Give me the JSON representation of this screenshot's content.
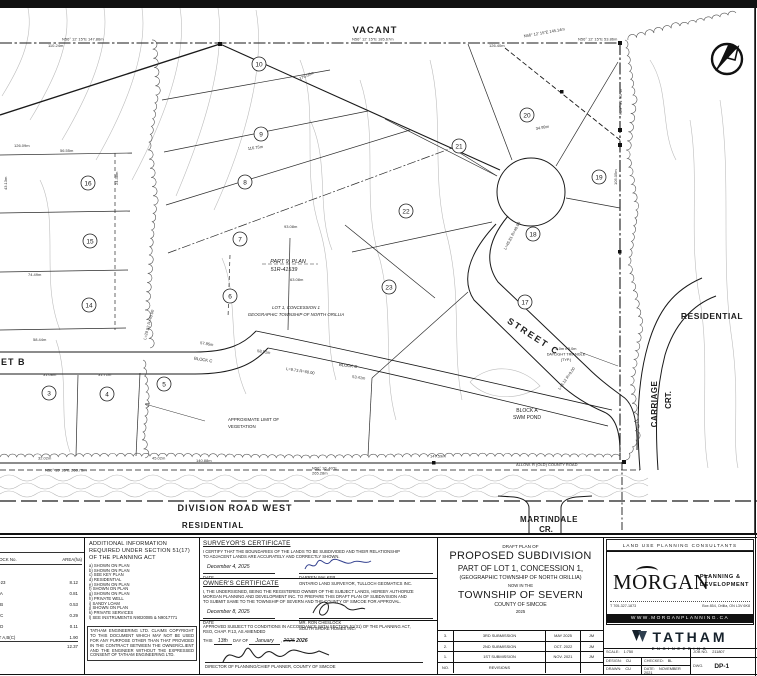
{
  "map": {
    "labels": {
      "vacant": "VACANT",
      "street_b": "STREET B",
      "street_c": "STREET C",
      "division_road": "DIVISION ROAD WEST",
      "residential_south": "RESIDENTIAL",
      "residential_east": "RESIDENTIAL",
      "martindale": "MARTINDALE",
      "martindale_cr": "CR.",
      "carriage": "CARRIAGE",
      "carriage_crt": "CRT.",
      "block_a_1": "BLOCK A",
      "block_a_2": "SWM POND",
      "block_c_1": "BLOCK C",
      "block_c_2": "BLOCK C",
      "part9_1": "PART 9, PLAN",
      "part9_2": "51R-41539",
      "lot1_1": "LOT 1, CONCESSION 1",
      "lot1_2": "GEOGRAPHIC TOWNSHIP OF NORTH ORILLIA",
      "veg_1": "APPROXIMATE LIMIT OF",
      "veg_2": "VEGETATION",
      "daylight_1": "5.0m x 5.0m",
      "daylight_2": "DAYLIGHT TRIANGLE",
      "daylight_3": "(TYP.)"
    },
    "lot_circles": [
      {
        "n": "3",
        "x": 49,
        "y": 393
      },
      {
        "n": "4",
        "x": 107,
        "y": 394
      },
      {
        "n": "5",
        "x": 164,
        "y": 384
      },
      {
        "n": "6",
        "x": 230,
        "y": 296
      },
      {
        "n": "7",
        "x": 240,
        "y": 239
      },
      {
        "n": "8",
        "x": 245,
        "y": 182
      },
      {
        "n": "9",
        "x": 261,
        "y": 134
      },
      {
        "n": "10",
        "x": 259,
        "y": 64
      },
      {
        "n": "14",
        "x": 89,
        "y": 305
      },
      {
        "n": "15",
        "x": 90,
        "y": 241
      },
      {
        "n": "16",
        "x": 88,
        "y": 183
      },
      {
        "n": "17",
        "x": 525,
        "y": 302
      },
      {
        "n": "18",
        "x": 533,
        "y": 234
      },
      {
        "n": "19",
        "x": 599,
        "y": 177
      },
      {
        "n": "20",
        "x": 527,
        "y": 115
      },
      {
        "n": "21",
        "x": 459,
        "y": 146
      },
      {
        "n": "22",
        "x": 406,
        "y": 211
      },
      {
        "n": "23",
        "x": 389,
        "y": 287
      }
    ],
    "dimension_labels": [
      {
        "t": "N56° 12' 15\"E  147.86m",
        "x": 62,
        "y": 40.5,
        "r": 0
      },
      {
        "t": "110.24m",
        "x": 48,
        "y": 47,
        "r": 0
      },
      {
        "t": "N56° 12' 15\"E  185.67m",
        "x": 352,
        "y": 40.5,
        "r": 0
      },
      {
        "t": "126.40m",
        "x": 489,
        "y": 47,
        "r": 0
      },
      {
        "t": "N56° 12' 15\"E 145.14m",
        "x": 524,
        "y": 37.5,
        "r": -10
      },
      {
        "t": "N56° 12' 15\"E  53.86m",
        "x": 578,
        "y": 40.5,
        "r": 0
      },
      {
        "t": "176.09m",
        "x": 300,
        "y": 80,
        "r": -24
      },
      {
        "t": "116.75m",
        "x": 248,
        "y": 150,
        "r": -8
      },
      {
        "t": "93.08m",
        "x": 284,
        "y": 228,
        "r": 0
      },
      {
        "t": "63.08m",
        "x": 290,
        "y": 281,
        "r": 0
      },
      {
        "t": "57.85m",
        "x": 200,
        "y": 344,
        "r": 9
      },
      {
        "t": "58.91m",
        "x": 257,
        "y": 352,
        "r": 9
      },
      {
        "t": "53.41m",
        "x": 352,
        "y": 378,
        "r": 7
      },
      {
        "t": "N29° 31' 30\"W",
        "x": 622,
        "y": 115,
        "r": -90
      },
      {
        "t": "105.05m",
        "x": 617,
        "y": 185,
        "r": -90
      },
      {
        "t": "N56° 15' 15\"E  268.75m",
        "x": 45,
        "y": 471.5,
        "r": 0
      },
      {
        "t": "140.88m",
        "x": 196,
        "y": 462,
        "r": 0
      },
      {
        "t": "45.02m",
        "x": 152,
        "y": 459.5,
        "r": 0
      },
      {
        "t": "32.02m",
        "x": 38,
        "y": 459.5,
        "r": 0
      },
      {
        "t": "31.08m",
        "x": 43,
        "y": 376,
        "r": 0
      },
      {
        "t": "31.71m",
        "x": 98,
        "y": 376,
        "r": 0
      },
      {
        "t": "24.38m",
        "x": 118,
        "y": 185,
        "r": -90
      },
      {
        "t": "74.49m",
        "x": 28,
        "y": 276,
        "r": 0
      },
      {
        "t": "58.44m",
        "x": 33,
        "y": 341,
        "r": 0
      },
      {
        "t": "56.55m",
        "x": 60,
        "y": 152,
        "r": 0
      },
      {
        "t": "126.09m",
        "x": 14,
        "y": 147,
        "r": 0
      },
      {
        "t": "43.13m",
        "x": 7,
        "y": 190,
        "r": -90
      },
      {
        "t": "147.59m",
        "x": 430,
        "y": 457.5,
        "r": 0
      },
      {
        "t": "N56° 16' 40\"E",
        "x": 312,
        "y": 469.5,
        "r": 0
      },
      {
        "t": "265.28m",
        "x": 312,
        "y": 474.5,
        "r": 0
      },
      {
        "t": "34.99m",
        "x": 536,
        "y": 130,
        "r": -10
      },
      {
        "t": "L=29.52 R=40.00",
        "x": 146,
        "y": 340,
        "r": -75
      },
      {
        "t": "L=9.73 R=60.00",
        "x": 286,
        "y": 370,
        "r": 9
      },
      {
        "t": "L=45.81 R=40.00",
        "x": 506,
        "y": 250,
        "r": -62
      },
      {
        "t": "L=8.12 R=9.00",
        "x": 560,
        "y": 390,
        "r": -55
      },
      {
        "t": "ALLOW. R (OLD) COUNTY ROAD",
        "x": 516,
        "y": 466,
        "r": 0
      }
    ]
  },
  "titleblock": {
    "area_table": {
      "head_col1": "LOT/BLOCK No.",
      "head_col2": "AREA(ha)",
      "rows": [
        {
          "label": "LOTS 1-23",
          "value": "8.12"
        },
        {
          "label": "BLOCK A",
          "value": "0.81"
        },
        {
          "label": "BLOCK B",
          "value": "0.53"
        },
        {
          "label": "BLOCK C",
          "value": "0.29"
        },
        {
          "label": "BLOCK D",
          "value": "0.11"
        },
        {
          "label": "STREET A,B(C)",
          "value": "1.90"
        }
      ],
      "total": "12.37"
    },
    "additional_info": {
      "title": "ADDITIONAL INFORMATION REQUIRED UNDER SECTION 51(17) OF THE PLANNING ACT",
      "items": [
        "a) SHOWN ON PLAN",
        "b) SHOWN ON PLAN",
        "c) SEE KEY PLAN",
        "d) RESIDENTIAL",
        "e) SHOWN ON PLAN",
        "f) SHOWN ON PLAN",
        "g) SHOWN ON PLAN",
        "h) PRIVATE WELL",
        "i) SANDY LOAM",
        "j) SHOWN ON PLAN",
        "k) PRIVATE SERVICES",
        "l) SEE INSTRUMENTS N9020085 & N9017771"
      ]
    },
    "copyright": "TATHAM ENGINEERING LTD. CLAIMS COPYRIGHT TO THIS DOCUMENT WHICH MAY NOT BE USED FOR ANY PURPOSE OTHER THAN THAT PROVIDED IN THE CONTRACT BETWEEN THE OWNER/CLIENT AND THE ENGINEER WITHOUT THE EXPRESSED CONSENT OF TATHAM ENGINEERING LTD.",
    "surveyor": {
      "title": "SURVEYOR'S CERTIFICATE",
      "body1": "I CERTIFY THAT THE BOUNDARIES OF THE LANDS TO BE SUBDIVIDED AND THEIR RELATIONSHIP",
      "body2": "TO ADJACENT LANDS ARE ACCURATELY AND CORRECTLY SHOWN.",
      "date": "December 4, 2025",
      "date_label": "DATE",
      "name": "DARREN WALKER",
      "name2": "ONTARIO LAND SURVEYOR, TULLOCH GEOMATICS INC."
    },
    "owner": {
      "title": "OWNER'S CERTIFICATE",
      "body1": "I, THE UNDERSIGNED, BEING THE REGISTERED OWNER OF THE SUBJECT LANDS, HEREBY AUTHORIZE",
      "body2": "MORGAN PLANNING AND DEVELOPMENT INC. TO PREPARE THIS DRAFT PLAN OF SUBDIVISION AND",
      "body3": "TO SUBMIT SAME TO THE TOWNSHIP OF SEVERN AND THE COUNTY OF SIMCOE FOR APPROVAL.",
      "date": "December 8, 2025",
      "date_label": "DATE",
      "name": "MR. RON CHESLOCK",
      "name2": "SOUTH SHORE HOMES INC."
    },
    "approval": {
      "line1": "APPROVED SUBJECT TO CONDITIONS IN ACCORDANCE WITH SECTION 51(31) OF THE PLANNING ACT,",
      "line2": "RSO, CHAP. P.13, AS AMENDED",
      "this_label": "THIS",
      "day": "13th",
      "dayof_label": "DAY OF",
      "month": "January",
      "comma": ",",
      "year_old": "2025",
      "year_new": "2026",
      "sig_title": "DIRECTOR OF PLANNING/CHIEF PLANNER, COUNTY OF SIMCOE"
    },
    "title": {
      "l1": "DRAFT PLAN OF",
      "l2": "PROPOSED SUBDIVISION",
      "l3": "PART OF LOT 1, CONCESSION 1,",
      "l4": "(GEOGRAPHIC TOWNSHIP OF NORTH ORILLIA)",
      "l5": "NOW IN THE",
      "l6": "TOWNSHIP OF SEVERN",
      "l7": "COUNTY OF SIMCOE",
      "l8": "2025"
    },
    "revisions": {
      "rows": [
        [
          "3.",
          "3RD SUBMISSION",
          "MAY 2025",
          "JM"
        ],
        [
          "2.",
          "2ND SUBMISSION",
          "OCT. 2022",
          "JM"
        ],
        [
          "1.",
          "1ST SUBMISSION",
          "NOV. 2021",
          "JM"
        ],
        [
          "NO.",
          "REVISIONS",
          "",
          ""
        ]
      ]
    },
    "consultant": {
      "band": "LAND USE PLANNING CONSULTANTS",
      "name": "MORGAN",
      "tag1": "PLANNING &",
      "tag2": "DEVELOPMENT",
      "phone": "T 705-327-1873",
      "address": "Box 854, Orillia, ON  L3V 6K8",
      "web": "WWW.MORGANPLANNING.CA"
    },
    "tatham": {
      "name": "TATHAM",
      "sub": "ENGINEERING"
    },
    "job": {
      "scale_label": "SCALE:",
      "scale": "1:750",
      "design_label": "DESIGN:",
      "design": "CU",
      "checked_label": "CHECKED:",
      "checked": "BL",
      "drawn_label": "DRAWN:",
      "drawn": "CU",
      "date_label": "DATE:",
      "date": "NOVEMBER 2021",
      "job_label": "JOB NO.",
      "job": "211807",
      "dwg_label": "DWG.",
      "dwg": "DP-1"
    }
  }
}
